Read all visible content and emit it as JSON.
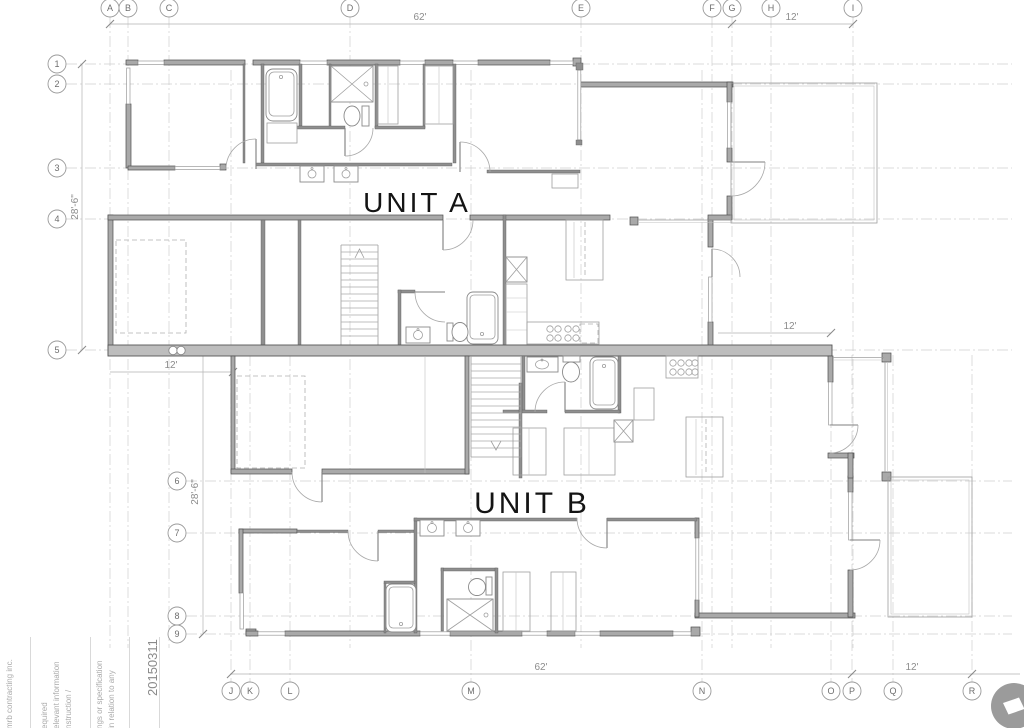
{
  "drawing": {
    "unit_a_label": "UNIT A",
    "unit_b_label": "UNIT B"
  },
  "grid": {
    "top": [
      "A",
      "B",
      "C",
      "D",
      "E",
      "F",
      "G",
      "H",
      "I"
    ],
    "bottom": [
      "J",
      "K",
      "L",
      "M",
      "N",
      "O",
      "P",
      "Q",
      "R"
    ],
    "rows_upper": [
      "1",
      "2",
      "3",
      "4",
      "5"
    ],
    "rows_lower": [
      "6",
      "7",
      "8",
      "9"
    ]
  },
  "dimensions": {
    "top_width": "62'",
    "top_right_width": "12'",
    "upper_height": "28'-6\"",
    "lower_height": "28'-6\"",
    "unit_b_left_width": "12'",
    "unit_a_right_width": "12'",
    "bottom_width": "62'",
    "bottom_right_width": "12'"
  },
  "title_block": {
    "company": "mrb contracting inc.",
    "notes": [
      "equired",
      "elevant information",
      "nstruction /",
      "ngs or specification",
      "in relation to any"
    ],
    "date": "20150311"
  },
  "logo": {
    "color": "#9b9b9b"
  }
}
